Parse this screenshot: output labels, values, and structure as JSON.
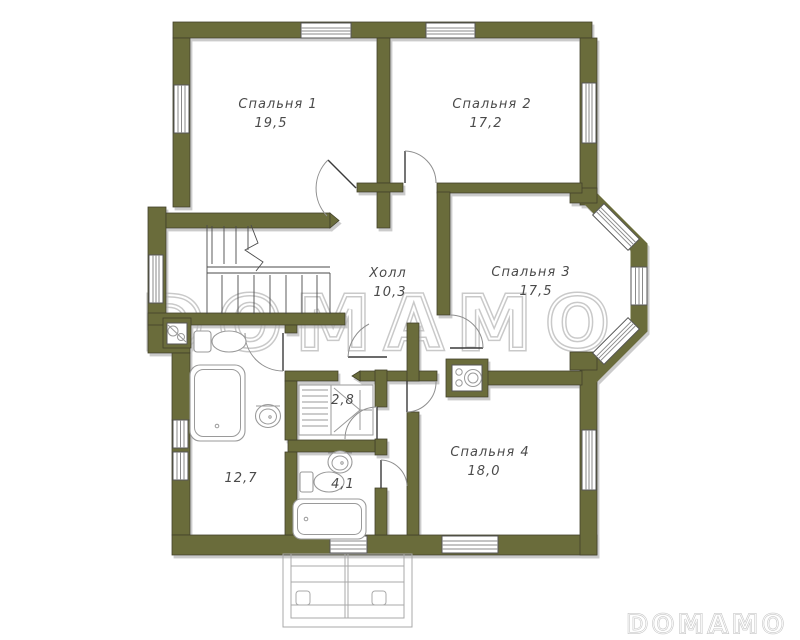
{
  "watermark": {
    "center": "DOMAMO",
    "corner": "DOMAMO"
  },
  "rooms": [
    {
      "id": "bedroom-1",
      "label": "Спальня 1",
      "area": "19,5"
    },
    {
      "id": "bedroom-2",
      "label": "Спальня 2",
      "area": "17,2"
    },
    {
      "id": "bedroom-3",
      "label": "Спальня 3",
      "area": "17,5"
    },
    {
      "id": "bedroom-4",
      "label": "Спальня 4",
      "area": "18,0"
    },
    {
      "id": "hall",
      "label": "Холл",
      "area": "10,3"
    },
    {
      "id": "closet",
      "area": "2,8"
    },
    {
      "id": "bathroom-small",
      "area": "4,1"
    },
    {
      "id": "bathroom-large",
      "area": "12,7"
    }
  ],
  "colors": {
    "wall": "#6b6c3a",
    "wall_outline": "#42422c",
    "fixture_outline": "#9a9a9a",
    "watermark_outline": "#c9c9c9",
    "label_text": "#4a4a4a"
  }
}
